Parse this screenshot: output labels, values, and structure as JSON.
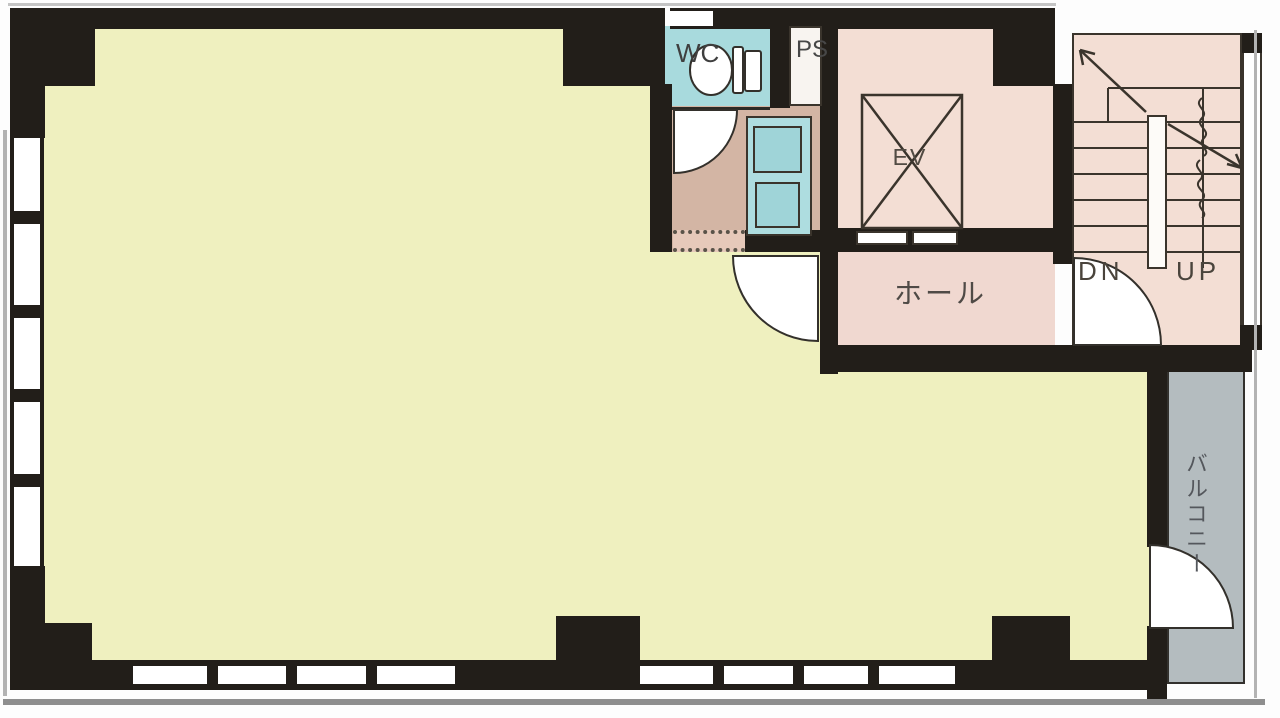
{
  "plan": {
    "type": "building-floor-plan",
    "rooms": {
      "wc": {
        "label": "WC"
      },
      "pipe_space": {
        "label": "PS"
      },
      "elevator": {
        "label": "EV"
      },
      "hall": {
        "label": "ホール"
      },
      "stairs": {
        "down_label": "DN",
        "up_label": "UP"
      },
      "balcony": {
        "label": "バルコニー"
      }
    },
    "colors": {
      "wall": "#221e19",
      "main_room": "#eff0bf",
      "service_pink": "#f3ded4",
      "hall_pink": "#f0d8d0",
      "wet_area_tan": "#d3b5a4",
      "fixture_cyan": "#a8dadd",
      "balcony_gray": "#b4bcbf"
    }
  }
}
